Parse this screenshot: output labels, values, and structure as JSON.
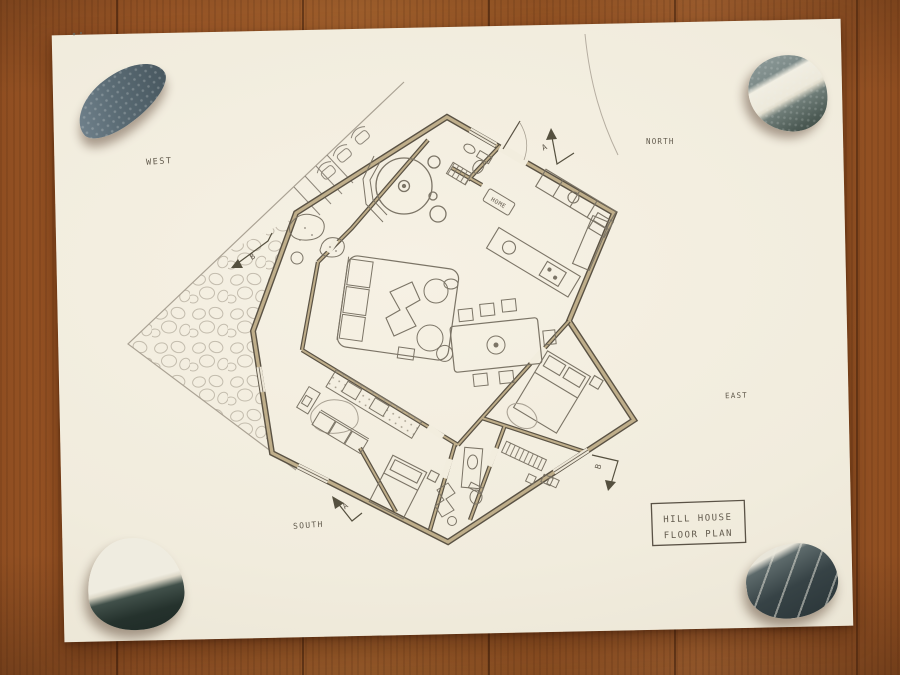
{
  "title_block": {
    "line1": "HILL HOUSE",
    "line2": "FLOOR PLAN"
  },
  "compass": {
    "west": "WEST",
    "north": "NORTH",
    "east": "EAST",
    "south": "SOUTH"
  },
  "section_markers": {
    "top": "A",
    "bottom": "A",
    "left": "B",
    "right": "B"
  },
  "doormat": {
    "label": "HOME"
  },
  "palette": {
    "wood": "#a85e2a",
    "paper": "#f2edde",
    "wall_ink": "#5a5244",
    "wall_fill": "#bfae8a",
    "pencil": "#7b7466",
    "pencil_light": "#aaa294",
    "text_ink": "#4e4639"
  },
  "stones": [
    {
      "name": "top-left-stone",
      "color": "#5a6b74"
    },
    {
      "name": "top-right-stone",
      "color": "#7e8c8a"
    },
    {
      "name": "bottom-left-stone",
      "color": "#25322d"
    },
    {
      "name": "bottom-right-stone",
      "color": "#374346"
    }
  ]
}
